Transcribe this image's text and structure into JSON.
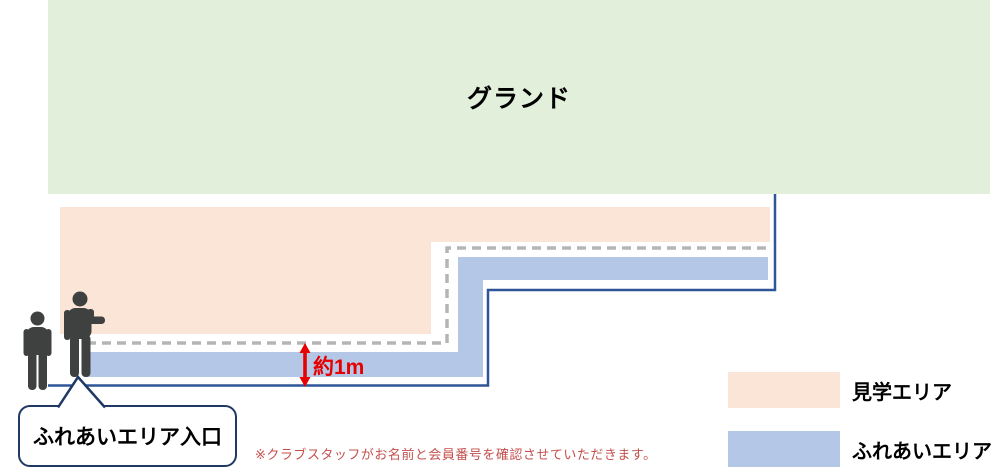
{
  "diagram": {
    "ground_label": "グランド",
    "distance_label": "約1m",
    "entrance_callout": "ふれあいエリア入口",
    "note": "※クラブスタッフがお名前と会員番号を確認させていただきます。"
  },
  "legend": {
    "items": [
      {
        "id": "viewing-area",
        "label": "見学エリア",
        "color": "#fbe5d6"
      },
      {
        "id": "interaction-area",
        "label": "ふれあいエリア",
        "color": "#b4c7e7"
      }
    ]
  },
  "colors": {
    "ground_green": "#e2efda",
    "viewing_area_peach": "#fbe5d6",
    "interaction_area_blue": "#b4c7e7",
    "boundary_navy": "#2e5597",
    "callout_border_navy": "#1f3864",
    "walkway_dash_gray": "#b5b5b5",
    "distance_red": "#e60000",
    "note_red": "#c3504e",
    "person_gray": "#3f4040"
  },
  "icons": {
    "person_left": "person-icon",
    "person_right": "person-pointing-icon",
    "distance_arrow": "vertical-double-arrow-icon"
  }
}
